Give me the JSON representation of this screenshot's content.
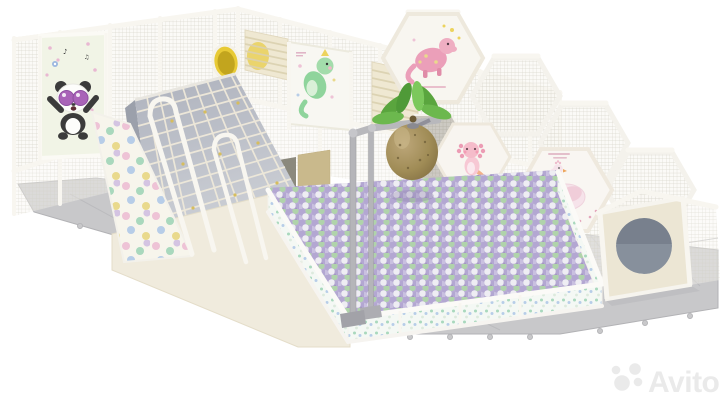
{
  "scene": {
    "subject": "Indoor soft-play playground 3D render",
    "background_color": "#ffffff",
    "floor": "grey interlocking puzzle mats"
  },
  "watermark": {
    "label": "Avito"
  },
  "art_panels": [
    {
      "name": "panda-art"
    },
    {
      "name": "green-dragon-art"
    },
    {
      "name": "pink-dinosaur-art"
    },
    {
      "name": "axolotl-art"
    },
    {
      "name": "swan-art"
    }
  ],
  "colors": {
    "floor_mat": "#c8c8ca",
    "mat_seam": "#b9b9bc",
    "structure_white": "#f6f4ee",
    "frame_cream": "#f8f6f0",
    "beige_panel": "#efe8d2",
    "beige_slat": "#dbd1b0",
    "slide_gray_top": "#aeb2bd",
    "slide_gray_bottom": "#ced1d7",
    "net_rope": "#efe9da",
    "net_knot": "#d6bd5e",
    "tube_yellow": "#e8ca35",
    "tube_yellow_inner": "#c2a51e",
    "ball_base": "#b9aed4",
    "ball_lavender": "#b3a7d2",
    "ball_mint": "#b0d3ab",
    "ball_white": "#eeedf3",
    "ball_lilac": "#c9c0e0",
    "coconut_brown": "#a08c56",
    "leaf_green": "#5aa53e",
    "pole_gray": "#b5b5b9",
    "hole_interior": "#87909c",
    "panda_black": "#3b3b3b",
    "glasses_purple": "#a963b8",
    "art_pink": "#eb9fb9",
    "art_green": "#8fd49c",
    "swan_rose": "#f6e3ea",
    "dot_pink": "#eec3d6",
    "dot_mint": "#a9d8bd",
    "dot_blue": "#b7cde8",
    "dot_yellow": "#e9d98c",
    "watermark": "#eaeaea"
  }
}
